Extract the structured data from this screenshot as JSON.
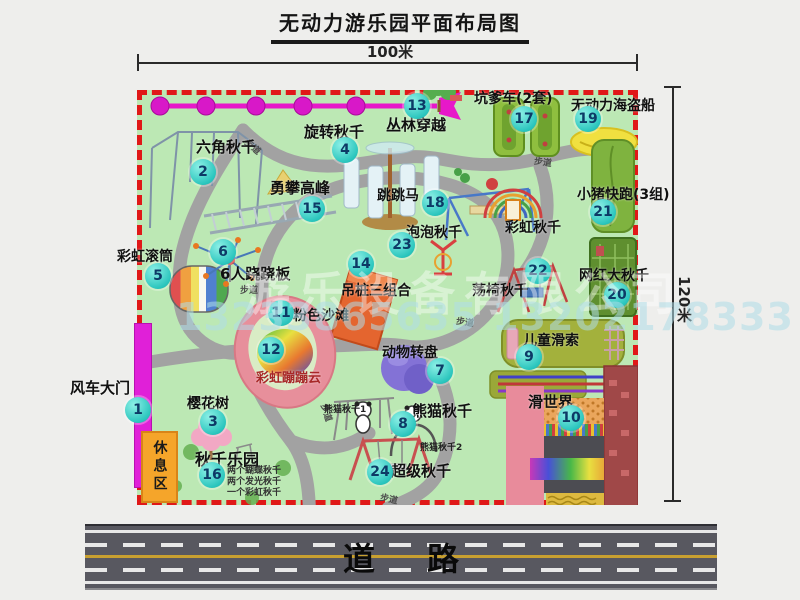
{
  "title": "无动力游乐园平面布局图",
  "dims": {
    "width": "100米",
    "height": "120米"
  },
  "road": {
    "label": "道路"
  },
  "watermark": {
    "company": "游乐设备有限公司",
    "phone": "13233865635 13202178333"
  },
  "rest_area": {
    "label": "休息区"
  },
  "park": {
    "path_label": "步道"
  },
  "colors": {
    "park_green": "#bce8b4",
    "boundary_red": "#e01818",
    "badge_cyan": "#2cc6be",
    "gate_magenta": "#e020d8",
    "rest_orange": "#f5a52a",
    "zipline_pink": "#e718c9",
    "road_gray": "#585860"
  },
  "attractions": {
    "a1": {
      "num": "1",
      "label": "风车大门"
    },
    "a2": {
      "num": "2",
      "label": "六角秋千"
    },
    "a3": {
      "num": "3",
      "label": "樱花树"
    },
    "a4": {
      "num": "4",
      "label": "旋转秋千"
    },
    "a5": {
      "num": "5",
      "label": "彩虹滚筒"
    },
    "a6": {
      "num": "6",
      "label": "6人跷跷板"
    },
    "a7": {
      "num": "7",
      "label": "动物转盘"
    },
    "a8": {
      "num": "8",
      "label": "熊猫秋千"
    },
    "a9": {
      "num": "9",
      "label": "儿童滑索"
    },
    "a10": {
      "num": "10",
      "label": "滑世界"
    },
    "a11": {
      "num": "11",
      "label": "粉色沙滩"
    },
    "a12": {
      "num": "12",
      "label": "彩虹蹦蹦云"
    },
    "a13": {
      "num": "13",
      "label": "丛林穿越"
    },
    "a14": {
      "num": "14",
      "label": "吊桩三组合"
    },
    "a15": {
      "num": "15",
      "label": "勇攀高峰"
    },
    "a16": {
      "num": "16",
      "label": "秋千乐园",
      "notes": [
        "两个蝴蝶秋千",
        "两个发光秋千",
        "一个彩虹秋千"
      ]
    },
    "a17": {
      "num": "17",
      "label": "坑爹车(2套)"
    },
    "a18": {
      "num": "18",
      "label": "跳跳马"
    },
    "a19": {
      "num": "19",
      "label": "无动力海盗船"
    },
    "a20": {
      "num": "20",
      "label": "网红大秋千"
    },
    "a21": {
      "num": "21",
      "label": "小猪快跑(3组)"
    },
    "a22": {
      "num": "22",
      "label": "荡椅秋千"
    },
    "a23": {
      "num": "23",
      "label": "泡泡秋千"
    },
    "a24": {
      "num": "24",
      "label": "超级秋千"
    },
    "rainbow_swing": {
      "label": "彩虹秋千"
    },
    "panda1": {
      "label": "熊猫秋千1"
    },
    "panda2": {
      "label": "熊猫秋千2"
    }
  }
}
